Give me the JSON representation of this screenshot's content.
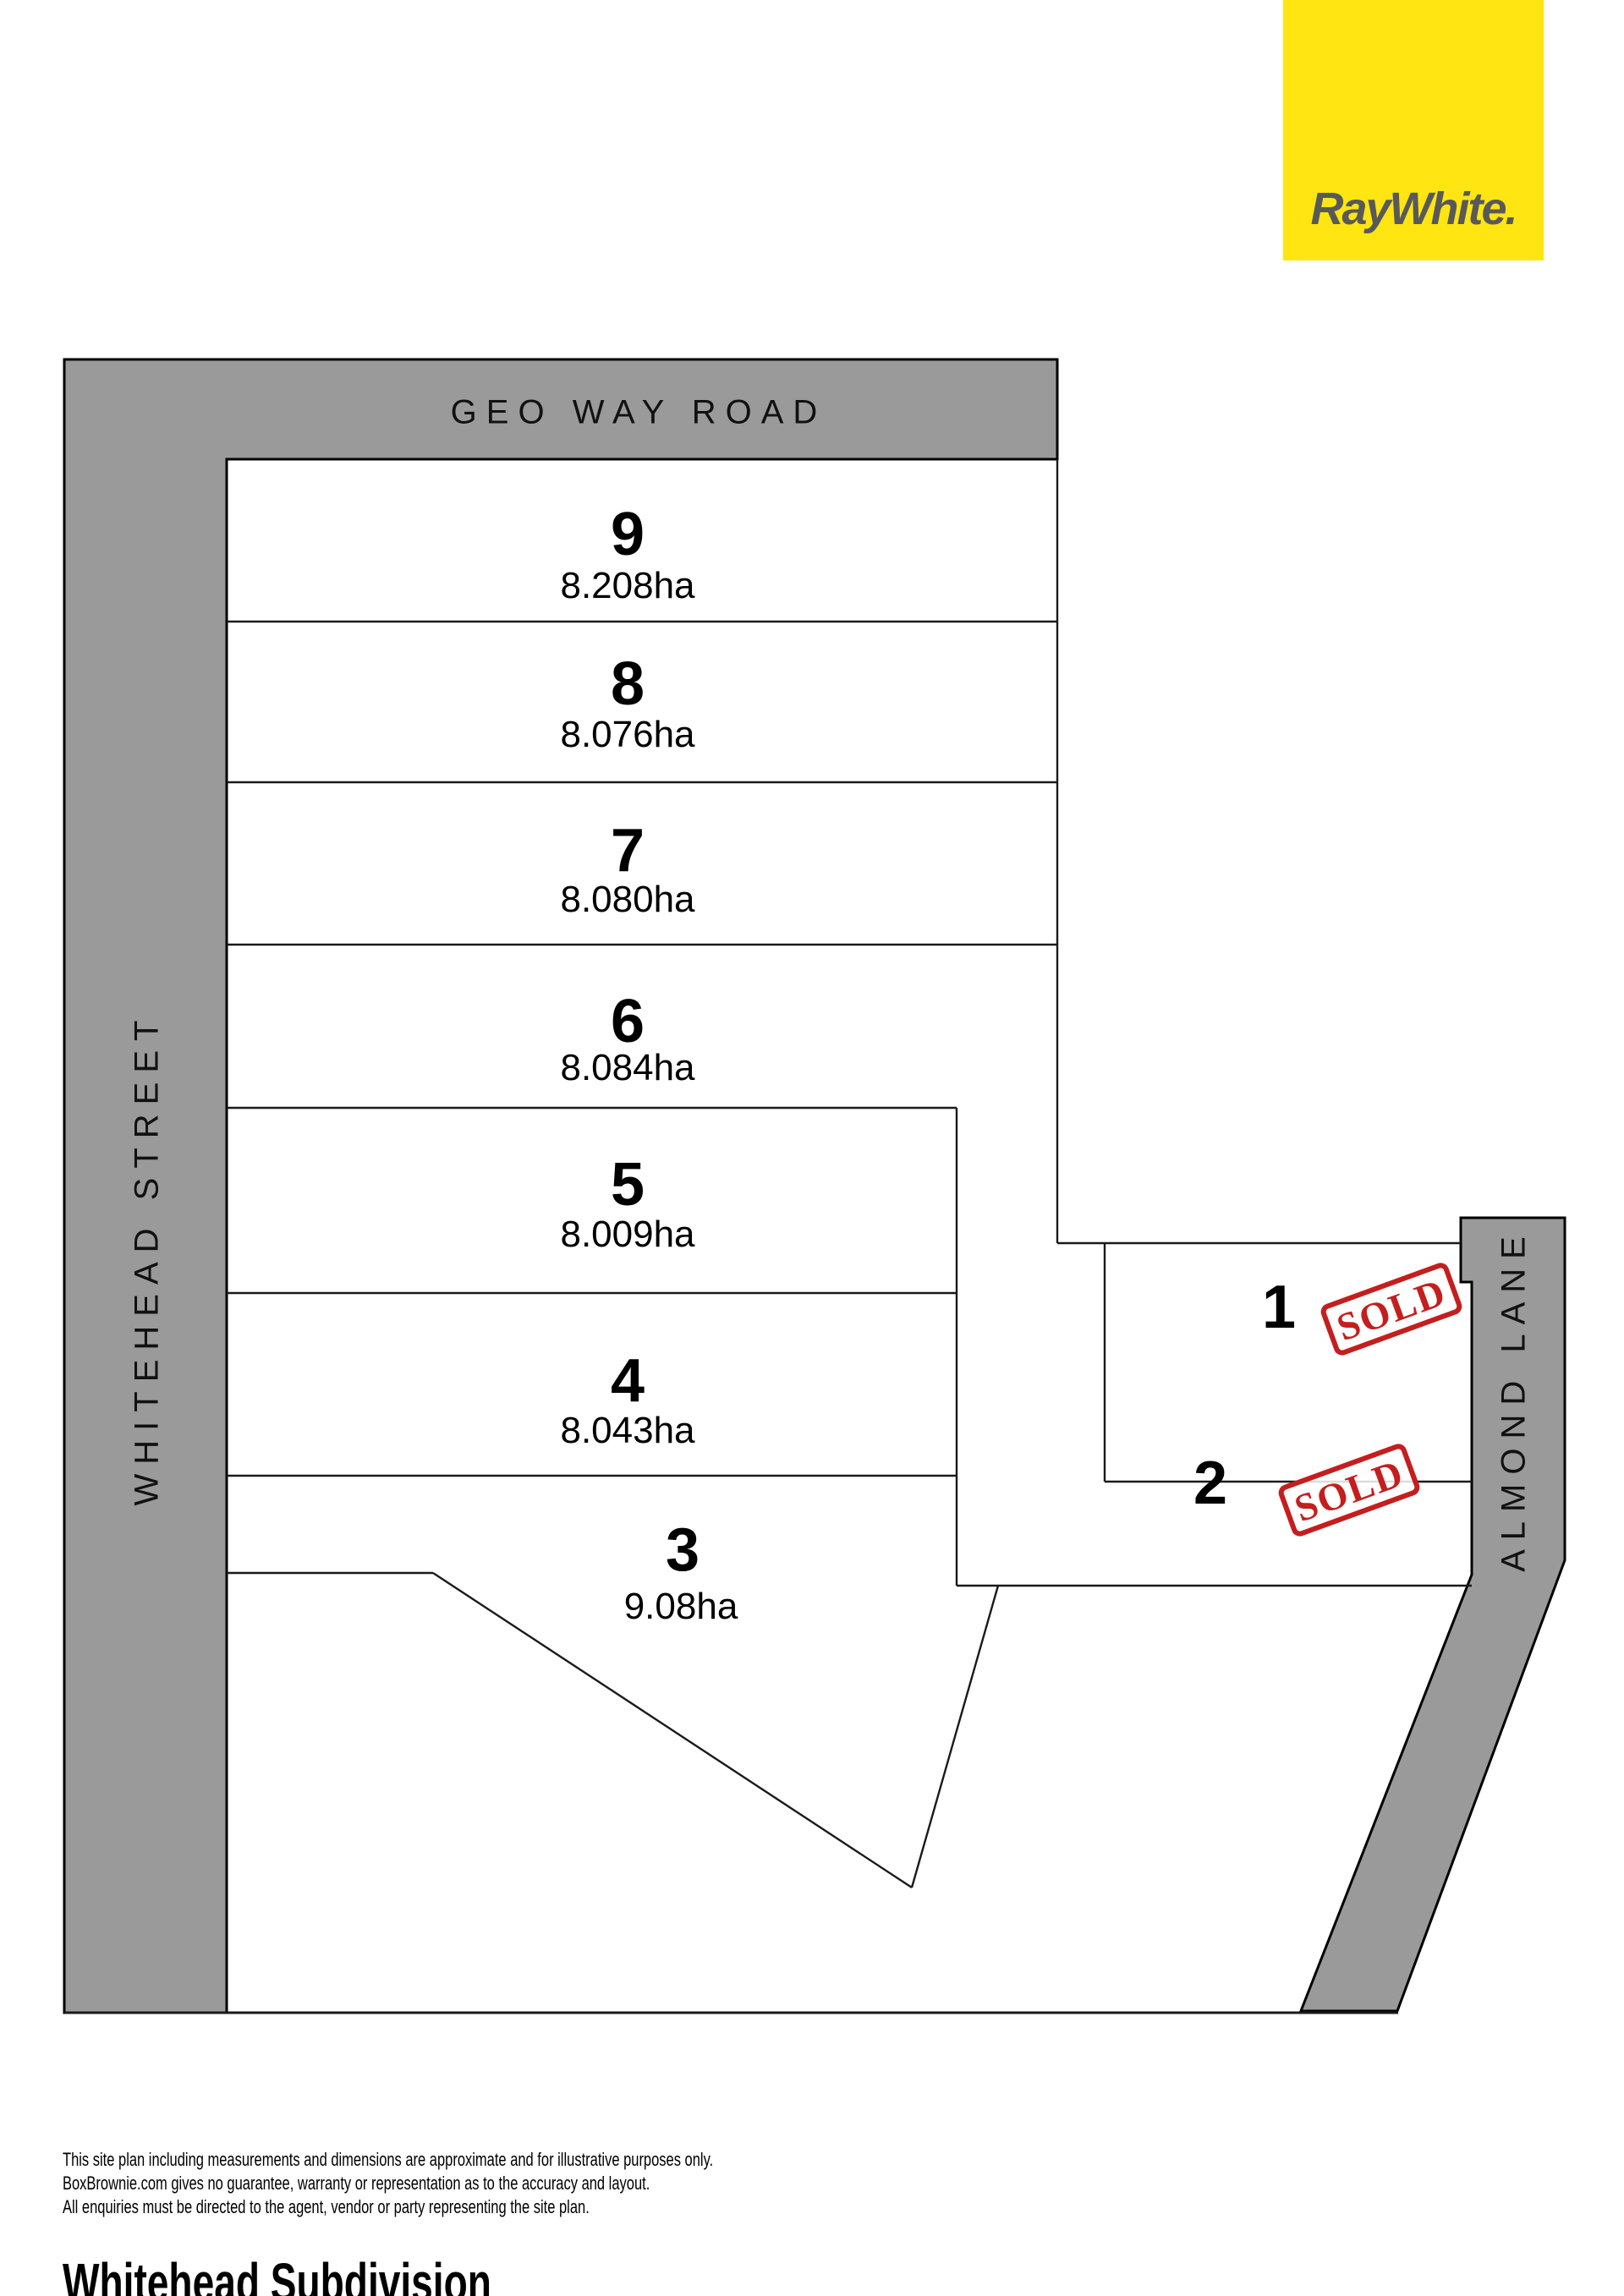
{
  "brand": {
    "logo_text": "RayWhite.",
    "logo_bg": "#FFE512",
    "logo_text_color": "#58595B"
  },
  "roads": [
    {
      "id": "geo-way-road",
      "name": "GEO WAY ROAD"
    },
    {
      "id": "whitehead-street",
      "name": "WHITEHEAD STREET"
    },
    {
      "id": "almond-lane",
      "name": "ALMOND LANE"
    }
  ],
  "lots": [
    {
      "number": "9",
      "area": "8.208ha",
      "status": "available"
    },
    {
      "number": "8",
      "area": "8.076ha",
      "status": "available"
    },
    {
      "number": "7",
      "area": "8.080ha",
      "status": "available"
    },
    {
      "number": "6",
      "area": "8.084ha",
      "status": "available"
    },
    {
      "number": "5",
      "area": "8.009ha",
      "status": "available"
    },
    {
      "number": "4",
      "area": "8.043ha",
      "status": "available"
    },
    {
      "number": "3",
      "area": "9.08ha",
      "status": "available"
    },
    {
      "number": "1",
      "area": "",
      "status": "sold"
    },
    {
      "number": "2",
      "area": "",
      "status": "sold"
    }
  ],
  "sold_stamp_text": "SOLD",
  "colors": {
    "road_gray": "#9A9A9A",
    "boundary_line": "#1A1A1A",
    "stamp_red": "#C41E1E",
    "brand_yellow": "#FFE512",
    "brand_gray": "#58595B"
  },
  "disclaimer": {
    "line1": "This site plan including measurements and dimensions are approximate and for illustrative purposes only.",
    "line2": "BoxBrownie.com gives no guarantee, warranty or representation as to the accuracy and layout.",
    "line3": "All enquiries must be directed to the agent, vendor or party representing the site plan."
  },
  "title": "Whitehead Subdivision"
}
